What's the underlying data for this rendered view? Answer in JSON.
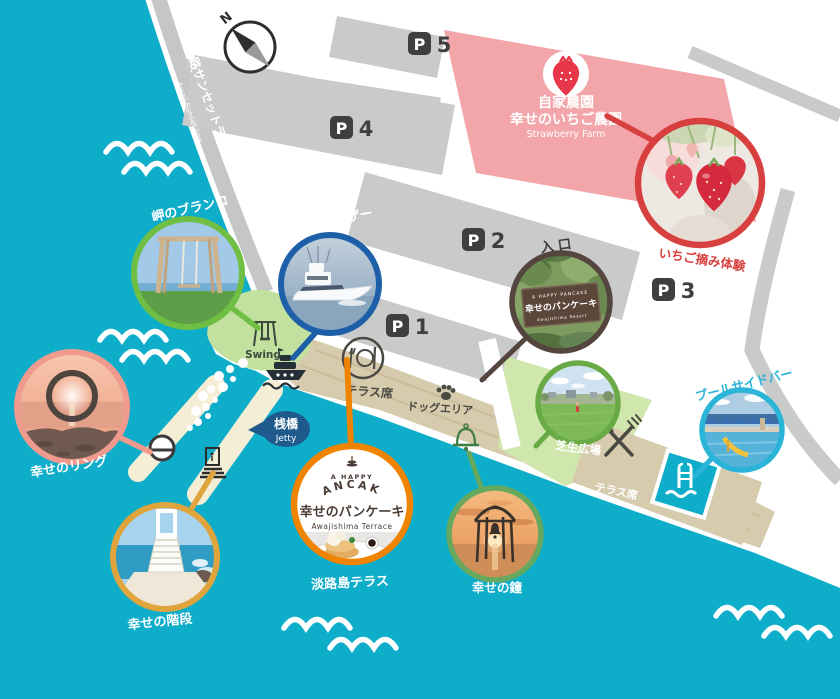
{
  "map": {
    "compass_n": "N",
    "road": {
      "jp": "淡路サンセットライン",
      "en": "Awaji Sunset line"
    },
    "parking": [
      {
        "p": "P",
        "n": "5"
      },
      {
        "p": "P",
        "n": "4"
      },
      {
        "p": "P",
        "n": "2"
      },
      {
        "p": "P",
        "n": "1"
      },
      {
        "p": "P",
        "n": "3"
      }
    ],
    "farm": {
      "l1": "自家農園",
      "l2": "幸せのいちご農園",
      "l3": "Strawberry Farm"
    },
    "spots": {
      "swing": "岬のブランコ",
      "cruiser": "専用クルーザー",
      "entrance": "入口",
      "strawberry": "いちご摘み体験",
      "ring": "幸せのリング",
      "stairs": "幸せの階段",
      "terrace": "淡路島テラス",
      "bell": "幸せの鐘",
      "lawn": "芝生広場",
      "pool": "プールサイドバー"
    },
    "labels": {
      "swing_en": "Swing",
      "jetty_jp": "桟橋",
      "jetty_en": "Jetty",
      "terrace_upper": "テラス席",
      "terrace_lower": "テラス席",
      "dog": "ドッグエリア"
    },
    "logo": {
      "a_happy": "A HAPPY",
      "pancake": "PANCAKE",
      "main": "幸せのパンケーキ",
      "sub": "Awajishima Terrace"
    },
    "entrance_sign": {
      "brand": "A HAPPY PANCAKE",
      "main": "幸せのパンケーキ",
      "sub": "Awajishima Resort"
    },
    "colors": {
      "water": "#0eadc9",
      "farm": "#f2a6aa",
      "spot_swing": "#6fbf44",
      "spot_cruiser": "#1d5fa8",
      "spot_entrance": "#54453e",
      "spot_strawberry": "#d84040",
      "spot_ring": "#f09a8e",
      "spot_stairs": "#dfa43c",
      "spot_terrace": "#f08300",
      "spot_bell": "#66a85e",
      "spot_lawn": "#6aaa46",
      "spot_pool": "#2ab4d8"
    }
  }
}
